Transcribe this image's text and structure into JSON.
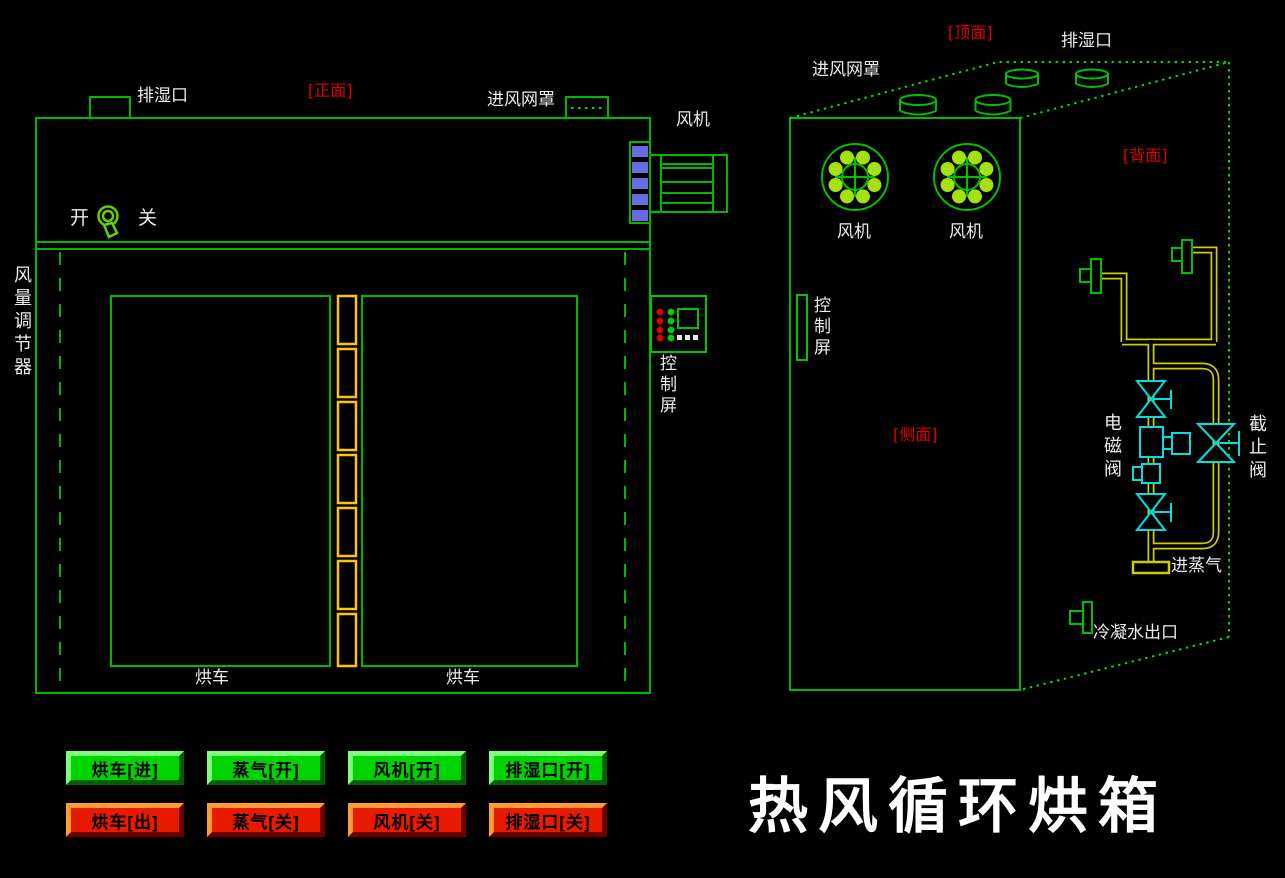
{
  "app": {
    "title": "热风循环烘箱"
  },
  "colors": {
    "background": "#000000",
    "line_green": "#00B800",
    "bright_green": "#00DC00",
    "fan_dot_green": "#A3E214",
    "hinge_yellow": "#FFC400",
    "pipe_yellow": "#CCCC00",
    "valve_cyan": "#00E0E0",
    "stripe_blue": "#6A6AE8",
    "label_white": "#EBEBEB",
    "label_red": "#E00000",
    "led_red": "#E00000",
    "led_green": "#00D000",
    "button_green": "#00D400",
    "button_red": "#E81A00"
  },
  "front_view": {
    "section_label": "[正面]",
    "exhaust_port": "排湿口",
    "inlet_mesh": "进风网罩",
    "fan": "风机",
    "switch_on": "开",
    "switch_off": "关",
    "air_regulator": "风量调节器",
    "control_screen": "控制屏",
    "cart_left": "烘车",
    "cart_right": "烘车"
  },
  "side_view": {
    "top_label": "[顶面]",
    "back_label": "[背面]",
    "side_label": "[侧面]",
    "inlet_mesh": "进风网罩",
    "exhaust_port": "排湿口",
    "fan_left": "风机",
    "fan_right": "风机",
    "control_screen": "控制屏",
    "solenoid_valve": "电磁阀",
    "stop_valve": "截止阀",
    "steam_inlet": "进蒸气",
    "condensate_outlet": "冷凝水出口"
  },
  "buttons": {
    "row1": [
      {
        "label": "烘车[进]"
      },
      {
        "label": "蒸气[开]"
      },
      {
        "label": "风机[开]"
      },
      {
        "label": "排湿口[开]"
      }
    ],
    "row2": [
      {
        "label": "烘车[出]"
      },
      {
        "label": "蒸气[关]"
      },
      {
        "label": "风机[关]"
      },
      {
        "label": "排湿口[关]"
      }
    ]
  }
}
